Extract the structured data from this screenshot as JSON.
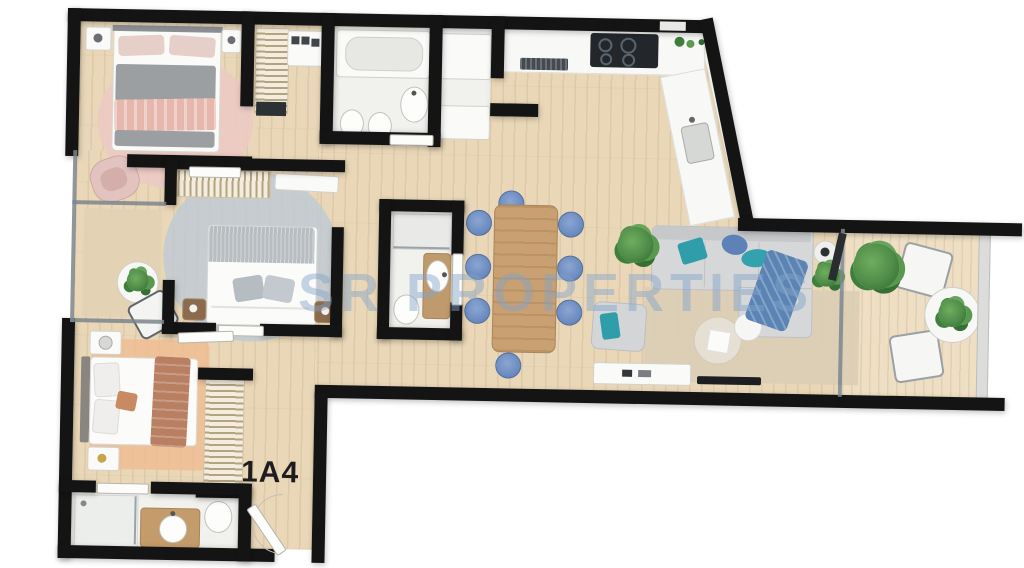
{
  "plan": {
    "unit_label": "1A4",
    "watermark": "SR PROPERTIES"
  },
  "colors": {
    "wall": "#141414",
    "floor_wood": "#e9d7b8",
    "floor_balcony": "#eedfc4",
    "rug_pink": "#ecc9c4",
    "rug_blue_gray": "#bdc9d5",
    "rug_terracotta": "#eebd92",
    "rug_living": "#dbcdb6",
    "sofa_gray": "#d6d7d9",
    "pillow_teal": "#2f9daa",
    "chair_blue": "#6d8cc0",
    "throw_blue": "#5b84b4",
    "table_wood": "#c9a071",
    "plant_green": "#4e8c49",
    "watermark_blue": "#82a3cb"
  },
  "icons": {
    "bed-icon": "css-shape",
    "sofa-icon": "css-shape",
    "bathtub-icon": "css-shape",
    "sink-icon": "css-shape",
    "toilet-icon": "css-shape",
    "shower-icon": "css-shape",
    "wardrobe-hangers-icon": "css-lines",
    "dining-table-icon": "css-shape",
    "dining-chair-icon": "css-circle",
    "cooktop-icon": "css-shape",
    "tv-icon": "css-bar",
    "plant-icon": "css-blob",
    "door-icon": "css-slab"
  }
}
